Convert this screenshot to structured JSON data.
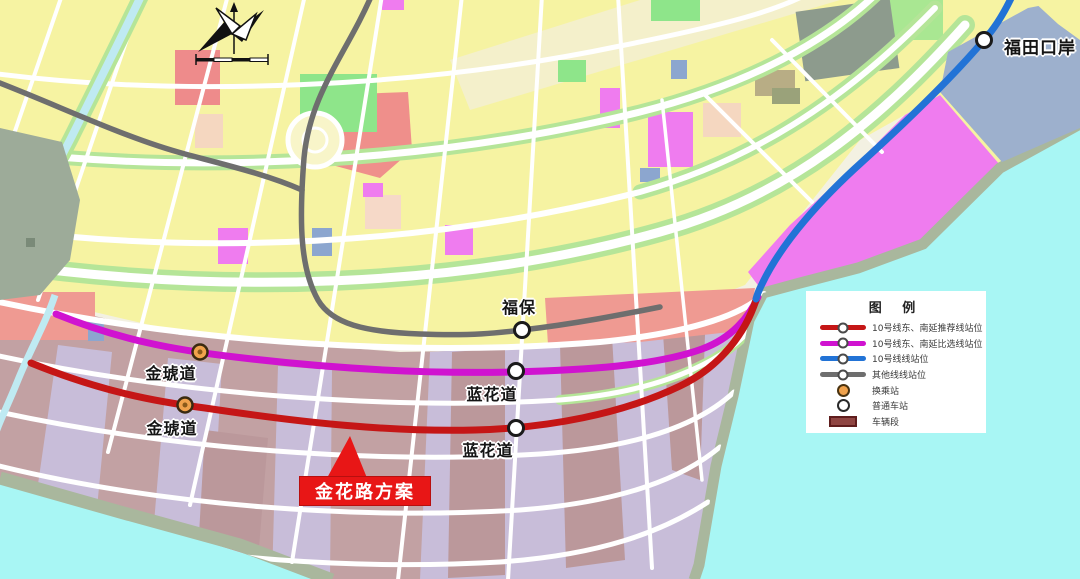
{
  "map": {
    "region_names": [],
    "stations": [
      {
        "name": "福田口岸",
        "type": "普通车站",
        "line": "10号线"
      },
      {
        "name": "福保",
        "type": "普通车站",
        "line": "其他线"
      },
      {
        "name": "金琥道",
        "type": "换乘站",
        "line": "10号线东、南延比选线"
      },
      {
        "name": "金琥道",
        "type": "换乘站",
        "line": "10号线东、南延推荐线"
      },
      {
        "name": "蓝花道",
        "type": "普通车站",
        "line": "10号线东、南延比选线"
      },
      {
        "name": "蓝花道",
        "type": "普通车站",
        "line": "10号线东、南延推荐线"
      }
    ],
    "callout": {
      "label": "金花路方案",
      "color": "#e81616"
    }
  },
  "legend": {
    "title": "图 例",
    "items": [
      {
        "label": "10号线东、南延推荐线站位",
        "swatch": "line",
        "color": "#c51616"
      },
      {
        "label": "10号线东、南延比选线站位",
        "swatch": "line",
        "color": "#d013d0"
      },
      {
        "label": "10号线线站位",
        "swatch": "line",
        "color": "#2273d6"
      },
      {
        "label": "其他线线站位",
        "swatch": "line",
        "color": "#6e6e6e"
      },
      {
        "label": "换乘站",
        "swatch": "transfer-station",
        "color": "#f0a24c"
      },
      {
        "label": "普通车站",
        "swatch": "regular-station",
        "color": "#ffffff"
      },
      {
        "label": "车辆段",
        "swatch": "depot",
        "color": "#8f4542"
      }
    ]
  },
  "colors": {
    "water": "#a8f6f4",
    "recommended_line": "#c51616",
    "alternative_line": "#d013d0",
    "line10": "#2273d6",
    "other_line": "#6e6e6e",
    "callout_red": "#e81616"
  }
}
